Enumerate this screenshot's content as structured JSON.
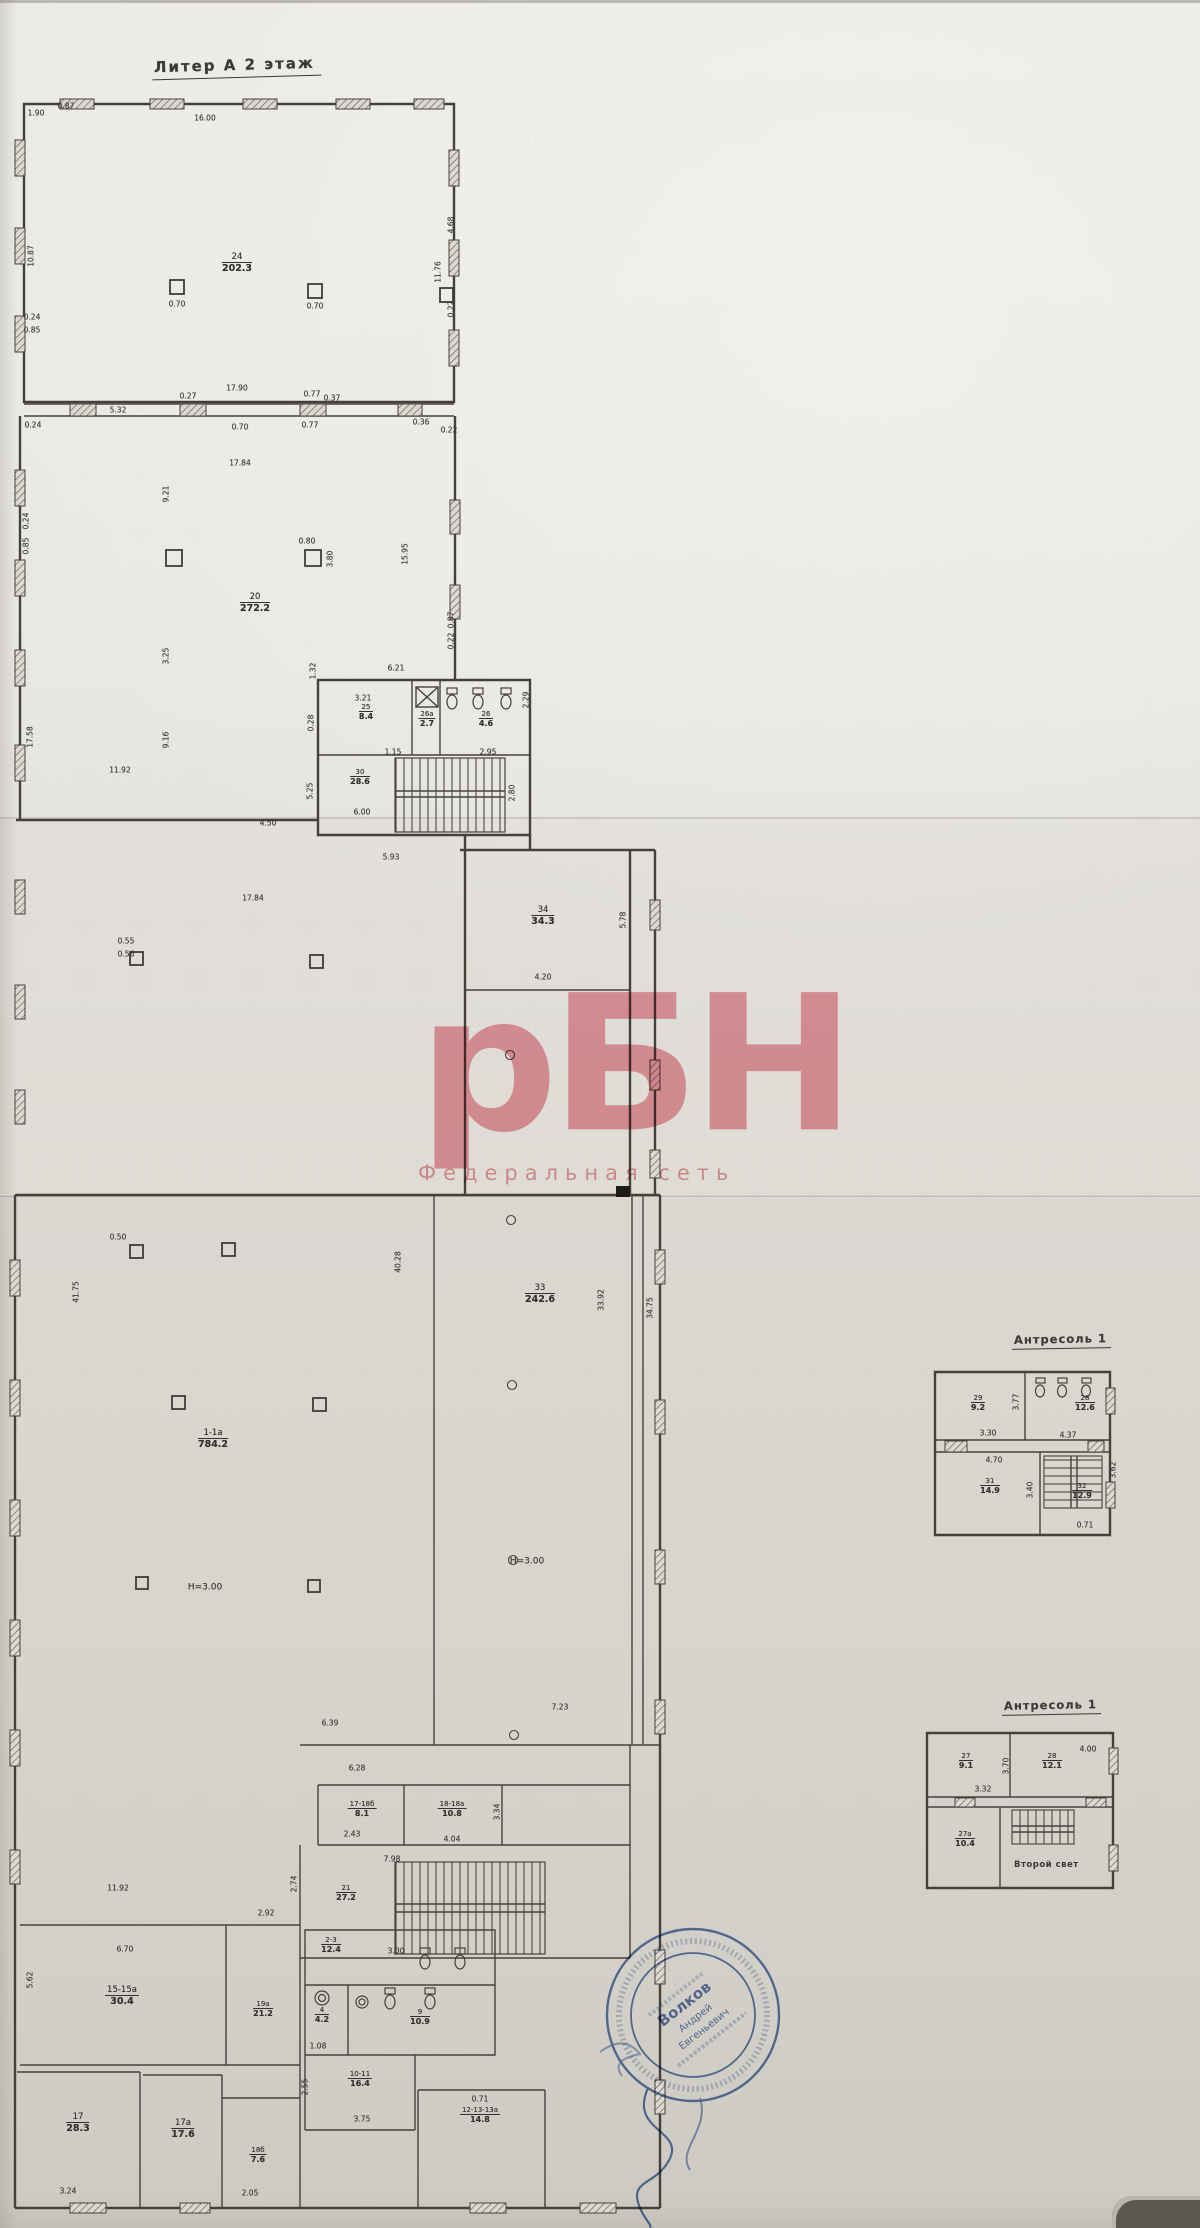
{
  "document": {
    "floor_title": "Литер А  2 этаж",
    "mezzanine1_title": "Антресоль 1",
    "mezzanine2_title": "Антресоль 1",
    "second_light_label": "Второй свет",
    "watermark": {
      "logo": "рБН",
      "subtitle": "Федеральная сеть",
      "color": "#e0505f"
    },
    "stamp": {
      "line1": "Волков",
      "line2": "Андрей",
      "line3": "Евгеньевич",
      "color": "#3c5e9d"
    }
  },
  "floor_plan": {
    "rooms": [
      {
        "n": "24",
        "a": "202.3",
        "x": 237,
        "y": 252
      },
      {
        "n": "20",
        "a": "272.2",
        "x": 255,
        "y": 592
      },
      {
        "n": "25",
        "a": "8.4",
        "x": 366,
        "y": 703,
        "sm": 1
      },
      {
        "n": "26а",
        "a": "2.7",
        "x": 427,
        "y": 710,
        "sm": 1
      },
      {
        "n": "26",
        "a": "4.6",
        "x": 486,
        "y": 710,
        "sm": 1
      },
      {
        "n": "30",
        "a": "28.6",
        "x": 360,
        "y": 768,
        "sm": 1
      },
      {
        "n": "34",
        "a": "34.3",
        "x": 543,
        "y": 905
      },
      {
        "n": "33",
        "a": "242.6",
        "x": 540,
        "y": 1283
      },
      {
        "n": "1-1а",
        "a": "784.2",
        "x": 213,
        "y": 1428
      },
      {
        "n": "17-18б",
        "a": "8.1",
        "x": 362,
        "y": 1800,
        "sm": 1
      },
      {
        "n": "18-18а",
        "a": "10.8",
        "x": 452,
        "y": 1800,
        "sm": 1
      },
      {
        "n": "21",
        "a": "27.2",
        "x": 346,
        "y": 1884,
        "sm": 1
      },
      {
        "n": "15-15а",
        "a": "30.4",
        "x": 122,
        "y": 1985
      },
      {
        "n": "19а",
        "a": "21.2",
        "x": 263,
        "y": 2000,
        "sm": 1
      },
      {
        "n": "2-3",
        "a": "12.4",
        "x": 331,
        "y": 1936,
        "sm": 1
      },
      {
        "n": "4",
        "a": "4.2",
        "x": 322,
        "y": 2006,
        "sm": 1
      },
      {
        "n": "9",
        "a": "10.9",
        "x": 420,
        "y": 2008,
        "sm": 1
      },
      {
        "n": "10-11",
        "a": "16.4",
        "x": 360,
        "y": 2070,
        "sm": 1
      },
      {
        "n": "12-13-13а",
        "a": "14.8",
        "x": 480,
        "y": 2106,
        "sm": 1
      },
      {
        "n": "17",
        "a": "28.3",
        "x": 78,
        "y": 2112
      },
      {
        "n": "17а",
        "a": "17.6",
        "x": 183,
        "y": 2118
      },
      {
        "n": "18б",
        "a": "7.6",
        "x": 258,
        "y": 2146,
        "sm": 1
      }
    ],
    "dims": [
      {
        "t": "16.00",
        "x": 205,
        "y": 118
      },
      {
        "t": "1.90",
        "x": 36,
        "y": 113
      },
      {
        "t": "0.87",
        "x": 66,
        "y": 106
      },
      {
        "t": "10.87",
        "x": 31,
        "y": 256,
        "r": 1
      },
      {
        "t": "0.70",
        "x": 177,
        "y": 304
      },
      {
        "t": "0.70",
        "x": 315,
        "y": 306
      },
      {
        "t": "4.68",
        "x": 451,
        "y": 225,
        "r": 1
      },
      {
        "t": "11.76",
        "x": 438,
        "y": 272,
        "r": 1
      },
      {
        "t": "0.22",
        "x": 451,
        "y": 309,
        "r": 1
      },
      {
        "t": "0.24",
        "x": 32,
        "y": 317
      },
      {
        "t": "0.85",
        "x": 32,
        "y": 330
      },
      {
        "t": "17.90",
        "x": 237,
        "y": 388
      },
      {
        "t": "0.27",
        "x": 188,
        "y": 396
      },
      {
        "t": "0.77",
        "x": 312,
        "y": 394
      },
      {
        "t": "0.37",
        "x": 332,
        "y": 398
      },
      {
        "t": "5.32",
        "x": 118,
        "y": 410
      },
      {
        "t": "0.24",
        "x": 33,
        "y": 425
      },
      {
        "t": "0.70",
        "x": 240,
        "y": 427
      },
      {
        "t": "0.77",
        "x": 310,
        "y": 425
      },
      {
        "t": "0.36",
        "x": 421,
        "y": 422
      },
      {
        "t": "0.22",
        "x": 449,
        "y": 430
      },
      {
        "t": "17.84",
        "x": 240,
        "y": 463
      },
      {
        "t": "9.21",
        "x": 166,
        "y": 494,
        "r": 1
      },
      {
        "t": "0.24",
        "x": 26,
        "y": 521,
        "r": 1
      },
      {
        "t": "0.85",
        "x": 26,
        "y": 546,
        "r": 1
      },
      {
        "t": "0.80",
        "x": 307,
        "y": 541
      },
      {
        "t": "3.80",
        "x": 330,
        "y": 559,
        "r": 1
      },
      {
        "t": "15.95",
        "x": 405,
        "y": 554,
        "r": 1
      },
      {
        "t": "0.87",
        "x": 451,
        "y": 620,
        "r": 1
      },
      {
        "t": "0.22",
        "x": 451,
        "y": 641,
        "r": 1
      },
      {
        "t": "3.25",
        "x": 166,
        "y": 656,
        "r": 1
      },
      {
        "t": "17.58",
        "x": 30,
        "y": 737,
        "r": 1
      },
      {
        "t": "9.16",
        "x": 166,
        "y": 740,
        "r": 1
      },
      {
        "t": "11.92",
        "x": 120,
        "y": 770
      },
      {
        "t": "0.55",
        "x": 126,
        "y": 941
      },
      {
        "t": "0.56",
        "x": 126,
        "y": 954
      },
      {
        "t": "6.21",
        "x": 396,
        "y": 668
      },
      {
        "t": "3.21",
        "x": 363,
        "y": 698
      },
      {
        "t": "1.32",
        "x": 313,
        "y": 671,
        "r": 1
      },
      {
        "t": "0.28",
        "x": 311,
        "y": 723,
        "r": 1
      },
      {
        "t": "1.15",
        "x": 393,
        "y": 752
      },
      {
        "t": "2.95",
        "x": 488,
        "y": 752
      },
      {
        "t": "2.29",
        "x": 526,
        "y": 700,
        "r": 1
      },
      {
        "t": "6.00",
        "x": 362,
        "y": 812
      },
      {
        "t": "2.80",
        "x": 512,
        "y": 793,
        "r": 1
      },
      {
        "t": "5.25",
        "x": 310,
        "y": 791,
        "r": 1
      },
      {
        "t": "4.50",
        "x": 268,
        "y": 823
      },
      {
        "t": "5.93",
        "x": 391,
        "y": 857
      },
      {
        "t": "17.84",
        "x": 253,
        "y": 898
      },
      {
        "t": "4.20",
        "x": 543,
        "y": 977
      },
      {
        "t": "5.78",
        "x": 623,
        "y": 920,
        "r": 1
      },
      {
        "t": "0.50",
        "x": 118,
        "y": 1237
      },
      {
        "t": "40.28",
        "x": 398,
        "y": 1262,
        "r": 1
      },
      {
        "t": "41.75",
        "x": 76,
        "y": 1292,
        "r": 1
      },
      {
        "t": "33.92",
        "x": 601,
        "y": 1300,
        "r": 1
      },
      {
        "t": "34.75",
        "x": 650,
        "y": 1308,
        "r": 1
      },
      {
        "t": "Н=3.00",
        "x": 205,
        "y": 1588,
        "fs": 9
      },
      {
        "t": "Н=3.00",
        "x": 527,
        "y": 1562,
        "fs": 9
      },
      {
        "t": "7.23",
        "x": 560,
        "y": 1707
      },
      {
        "t": "6.39",
        "x": 330,
        "y": 1723
      },
      {
        "t": "6.28",
        "x": 357,
        "y": 1768
      },
      {
        "t": "2.43",
        "x": 352,
        "y": 1834
      },
      {
        "t": "4.04",
        "x": 452,
        "y": 1839
      },
      {
        "t": "3.34",
        "x": 497,
        "y": 1812,
        "r": 1
      },
      {
        "t": "7.98",
        "x": 392,
        "y": 1859
      },
      {
        "t": "11.92",
        "x": 118,
        "y": 1888
      },
      {
        "t": "6.70",
        "x": 125,
        "y": 1949
      },
      {
        "t": "5.62",
        "x": 30,
        "y": 1980,
        "r": 1
      },
      {
        "t": "2.92",
        "x": 266,
        "y": 1913
      },
      {
        "t": "2.74",
        "x": 294,
        "y": 1884,
        "r": 1
      },
      {
        "t": "3.00",
        "x": 396,
        "y": 1951
      },
      {
        "t": "1.08",
        "x": 318,
        "y": 2046
      },
      {
        "t": "3.75",
        "x": 362,
        "y": 2119
      },
      {
        "t": "0.71",
        "x": 480,
        "y": 2099
      },
      {
        "t": "3.24",
        "x": 68,
        "y": 2191
      },
      {
        "t": "2.05",
        "x": 250,
        "y": 2193
      },
      {
        "t": "2.55",
        "x": 305,
        "y": 2087,
        "r": 1
      }
    ]
  },
  "mezzanine1": {
    "rooms": [
      {
        "n": "29",
        "a": "9.2",
        "x": 978,
        "y": 1394,
        "sm": 1
      },
      {
        "n": "28",
        "a": "12.6",
        "x": 1085,
        "y": 1394,
        "sm": 1
      },
      {
        "n": "31",
        "a": "14.9",
        "x": 990,
        "y": 1477,
        "sm": 1
      },
      {
        "n": "32",
        "a": "12.9",
        "x": 1082,
        "y": 1482,
        "sm": 1
      }
    ],
    "dims": [
      {
        "t": "3.77",
        "x": 1016,
        "y": 1402,
        "r": 1
      },
      {
        "t": "3.30",
        "x": 988,
        "y": 1433
      },
      {
        "t": "4.37",
        "x": 1068,
        "y": 1435
      },
      {
        "t": "4.70",
        "x": 994,
        "y": 1460
      },
      {
        "t": "3.40",
        "x": 1030,
        "y": 1490,
        "r": 1
      },
      {
        "t": "3.62",
        "x": 1113,
        "y": 1470,
        "r": 1
      },
      {
        "t": "0.71",
        "x": 1085,
        "y": 1525
      }
    ]
  },
  "mezzanine2": {
    "rooms": [
      {
        "n": "27",
        "a": "9.1",
        "x": 966,
        "y": 1752,
        "sm": 1
      },
      {
        "n": "28",
        "a": "12.1",
        "x": 1052,
        "y": 1752,
        "sm": 1
      },
      {
        "n": "27а",
        "a": "10.4",
        "x": 965,
        "y": 1830,
        "sm": 1
      }
    ],
    "dims": [
      {
        "t": "4.00",
        "x": 1088,
        "y": 1749
      },
      {
        "t": "3.32",
        "x": 983,
        "y": 1789
      },
      {
        "t": "3.70",
        "x": 1006,
        "y": 1766,
        "r": 1
      }
    ]
  }
}
